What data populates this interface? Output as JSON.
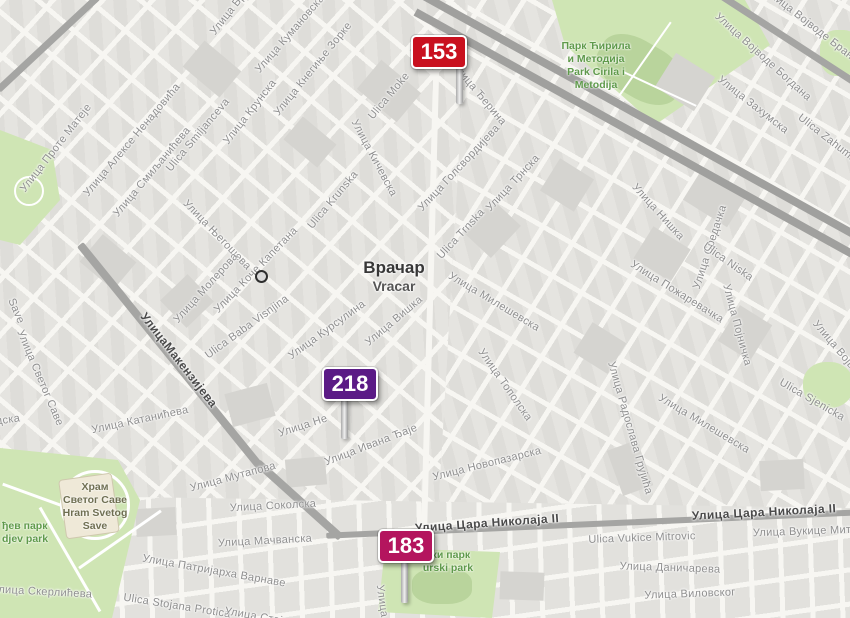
{
  "region": {
    "name_cyr": "Врачар",
    "name_lat": "Vracar"
  },
  "markers": [
    {
      "label": "153",
      "color": "#c9111f"
    },
    {
      "label": "218",
      "color": "#5b1b86"
    },
    {
      "label": "183",
      "color": "#b4155e"
    }
  ],
  "road_labels": [
    "УлицаМакензијева",
    "Улица Цара Николаја II",
    "Улица Цара Николаја II"
  ],
  "street_labels": [
    "Улица Проте Матеје",
    "Улица Алексе Ненадовића",
    "Улица Смиљанићева",
    "Ulica Smiljanceva",
    "Улица Крунска",
    "Ulica Krunska",
    "Улица Бр",
    "Улица Кумановска",
    "Улица Кнегиње Зорке",
    "Ulica Moke",
    "Улица Ђерина",
    "Улица Кичевска",
    "Улица Голсвордијева",
    "Ulica Trnska",
    "Улица Трнска",
    "Улица Његошева",
    "Улица Коче Капетана",
    "Улица Молерова",
    "Ulica Baba Visnjina",
    "Улица Курсулина",
    "Улица Вишка",
    "Улица Катанићева",
    "Улица Светог Саве",
    "Save",
    "дска",
    "Улица Нишка",
    "Улица Средачка",
    "Ulica Niska",
    "Улица Пожаревачка",
    "Улица Појничка",
    "Улица Захумска",
    "Улица Војводе Богдана",
    "Улица Војводе Бране",
    "Ulica Zahumska",
    "Улица Милешевска",
    "Улица Милешевска",
    "Улица Тополска",
    "Улица Новопазарска",
    "Улица Ивана Ђаје",
    "Улица Не",
    "Улица Мутапова",
    "Улица Соколска",
    "Улица Мачванска",
    "Улица Патријарха Варнаве",
    "Ulica Stojana Protica",
    "Улица Стојана Протића",
    "Улица Скерлићева",
    "Улица Радослава Грујића",
    "Ulica Sjenicka",
    "Улица Војводе",
    "Ulica Vukice Mitrovic",
    "Улица Вукице Митровић",
    "Улица Даничарева",
    "Улица Виловског",
    "Улица"
  ],
  "parks": [
    {
      "lines": [
        "Парк Ћирила",
        "и Методија",
        "Park Cirila i",
        "Metodija"
      ]
    },
    {
      "lines": [
        "Храм",
        "Светог Саве",
        "Hram Svetog",
        "Save"
      ]
    },
    {
      "lines": [
        "ђев парк",
        "djev park"
      ]
    },
    {
      "lines": [
        "ски парк",
        "urski park"
      ]
    }
  ],
  "colors": {
    "marker_red": "#c9111f",
    "marker_purple": "#5b1b86",
    "marker_crimson": "#b4155e",
    "park_green": "#cfe5b4",
    "road_gray": "#a5a5a3",
    "street_label_gray": "#8f8f8f",
    "park_label_green": "#5f9a4b"
  }
}
